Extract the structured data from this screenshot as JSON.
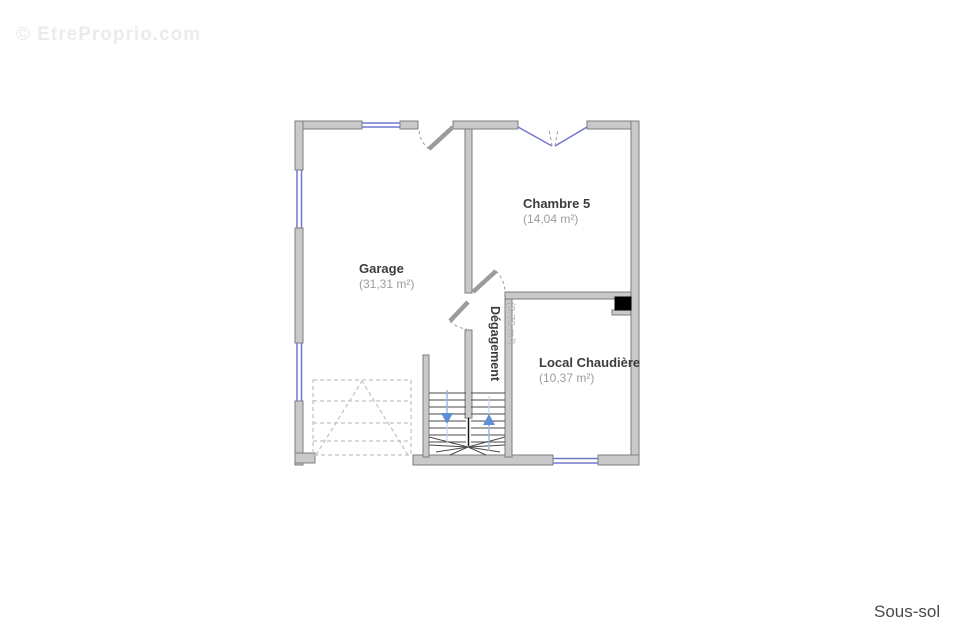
{
  "watermark": "© EtreProprio.com",
  "floor_label": "Sous-sol",
  "rooms": [
    {
      "name": "Garage",
      "area": "(31,31 m²)"
    },
    {
      "name": "Chambre 5",
      "area": "(14,04 m²)"
    },
    {
      "name": "Local Chaudière",
      "area": "(10,37 m²)"
    },
    {
      "name": "Dégagement",
      "area": "(3,76 m²)"
    }
  ],
  "colors": {
    "wall_fill": "#c9c9c9",
    "wall_stroke": "#7d7d7d",
    "window_blue": "#7277cf",
    "stair_walkline": "#9ab8e0",
    "stair_arrow": "#5f8fd4",
    "room_name": "#3c3c3c",
    "room_area": "#9c9c9c",
    "floor_label": "#4a4a4a",
    "watermark": "#ebebeb",
    "flue": "#000000",
    "dashed_outline": "#c2c2c2"
  }
}
